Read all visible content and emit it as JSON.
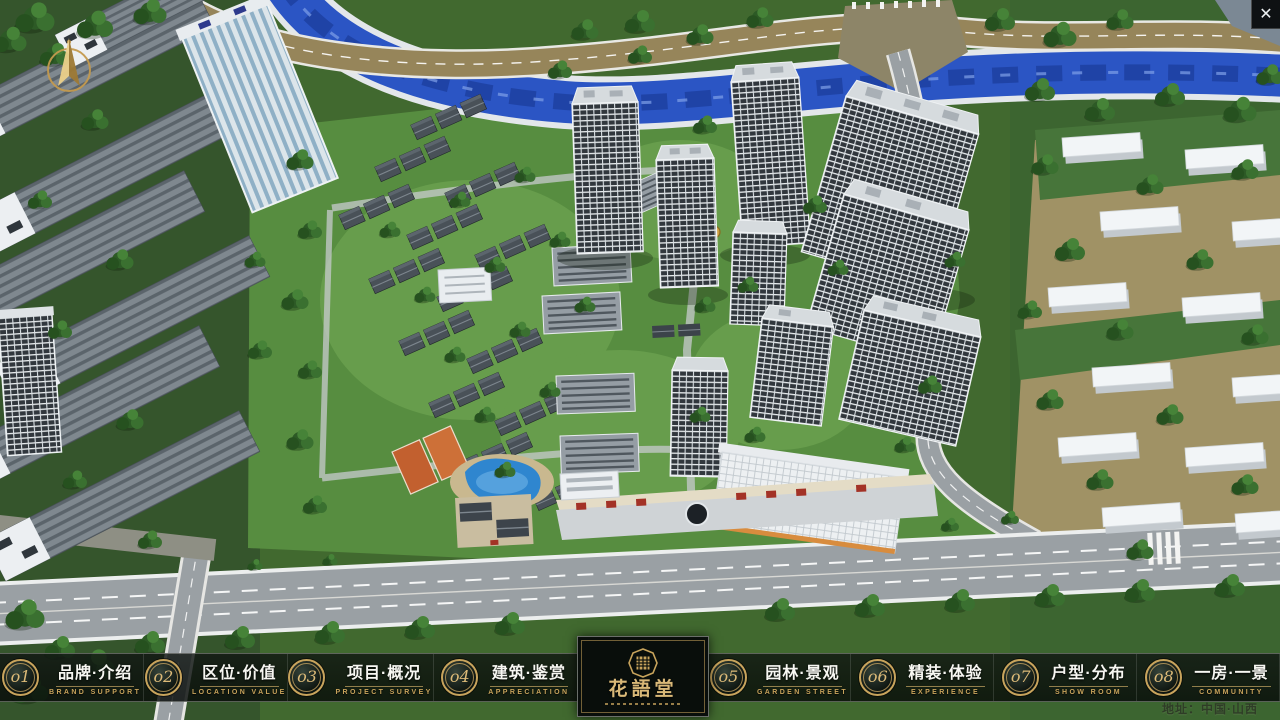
{
  "window": {
    "icons": {
      "close": "✕",
      "compass": "north-arrow"
    }
  },
  "colors": {
    "gold_accent": "#c8a45c",
    "bar_background": "rgba(10,14,12,0.8)"
  },
  "nav": {
    "items": [
      {
        "num": "o1",
        "zh": "品牌·介绍",
        "en": "BRAND SUPPORT"
      },
      {
        "num": "o2",
        "zh": "区位·价值",
        "en": "LOCATION VALUE"
      },
      {
        "num": "o3",
        "zh": "项目·概况",
        "en": "PROJECT SURVEY"
      },
      {
        "num": "o4",
        "zh": "建筑·鉴赏",
        "en": "APPRECIATION"
      },
      {
        "num": "o5",
        "zh": "园林·景观",
        "en": "GARDEN STREET"
      },
      {
        "num": "o6",
        "zh": "精装·体验",
        "en": "EXPERIENCE"
      },
      {
        "num": "o7",
        "zh": "户型·分布",
        "en": "SHOW ROOM"
      },
      {
        "num": "o8",
        "zh": "一房·一景",
        "en": "COMMUNITY"
      }
    ]
  },
  "logo": {
    "name": "花語堂"
  },
  "footer": {
    "address": "地址：中国·山西"
  }
}
